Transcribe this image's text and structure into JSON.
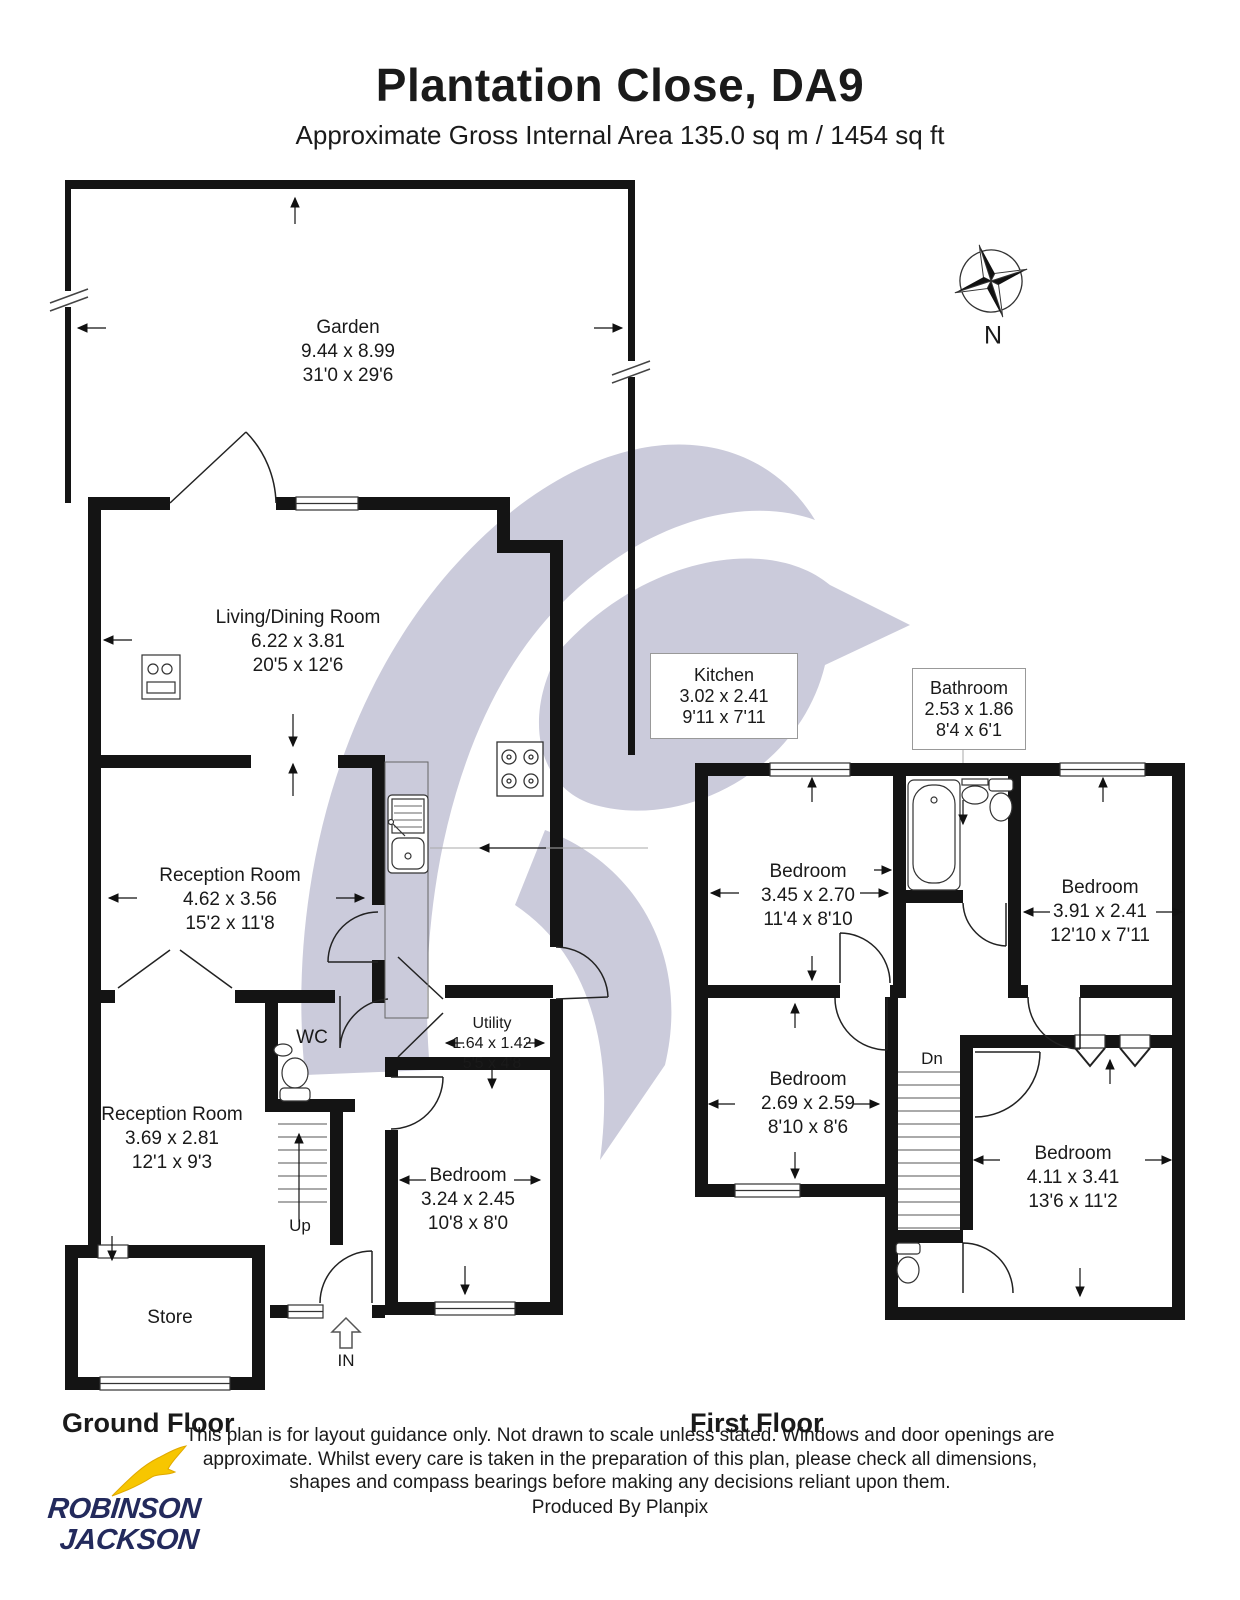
{
  "header": {
    "title": "Plantation Close, DA9",
    "subtitle": "Approximate Gross Internal Area 135.0 sq m / 1454 sq ft"
  },
  "compass": {
    "north_label": "N"
  },
  "ground_floor": {
    "label": "Ground Floor",
    "stairs_label": "Up",
    "entrance_label": "IN",
    "rooms": {
      "garden": {
        "name": "Garden",
        "metric": "9.44 x 8.99",
        "imperial": "31'0 x 29'6"
      },
      "living_dining": {
        "name": "Living/Dining Room",
        "metric": "6.22 x 3.81",
        "imperial": "20'5 x 12'6"
      },
      "kitchen": {
        "name": "Kitchen",
        "metric": "3.02 x 2.41",
        "imperial": "9'11 x 7'11"
      },
      "reception_1": {
        "name": "Reception Room",
        "metric": "4.62 x 3.56",
        "imperial": "15'2 x 11'8"
      },
      "reception_2": {
        "name": "Reception Room",
        "metric": "3.69 x 2.81",
        "imperial": "12'1 x 9'3"
      },
      "wc": {
        "name": "WC"
      },
      "utility": {
        "name": "Utility",
        "metric": "1.64 x 1.42",
        "imperial": "5'5 x 4'8"
      },
      "bedroom": {
        "name": "Bedroom",
        "metric": "3.24 x 2.45",
        "imperial": "10'8 x 8'0"
      },
      "store": {
        "name": "Store"
      }
    }
  },
  "first_floor": {
    "label": "First Floor",
    "stairs_label": "Dn",
    "rooms": {
      "bathroom": {
        "name": "Bathroom",
        "metric": "2.53 x 1.86",
        "imperial": "8'4 x 6'1"
      },
      "bedroom_1": {
        "name": "Bedroom",
        "metric": "3.45 x 2.70",
        "imperial": "11'4 x 8'10"
      },
      "bedroom_2": {
        "name": "Bedroom",
        "metric": "3.91 x 2.41",
        "imperial": "12'10 x 7'11"
      },
      "bedroom_3": {
        "name": "Bedroom",
        "metric": "2.69 x 2.59",
        "imperial": "8'10 x 8'6"
      },
      "bedroom_4": {
        "name": "Bedroom",
        "metric": "4.11 x 3.41",
        "imperial": "13'6 x 11'2"
      }
    }
  },
  "footer": {
    "disclaimer": "This plan is for layout guidance only. Not drawn to scale unless stated. Windows and door openings are approximate. Whilst every care is taken in the preparation of this plan, please check all dimensions, shapes and compass bearings before making any decisions reliant upon them.",
    "produced_by": "Produced By Planpix"
  },
  "logo": {
    "line_1": "ROBINSON",
    "line_2": "JACKSON"
  },
  "colors": {
    "wall": "#141414",
    "watermark": "#cbcbdb",
    "logo_navy": "#232a5c",
    "logo_yellow": "#f7c600"
  }
}
